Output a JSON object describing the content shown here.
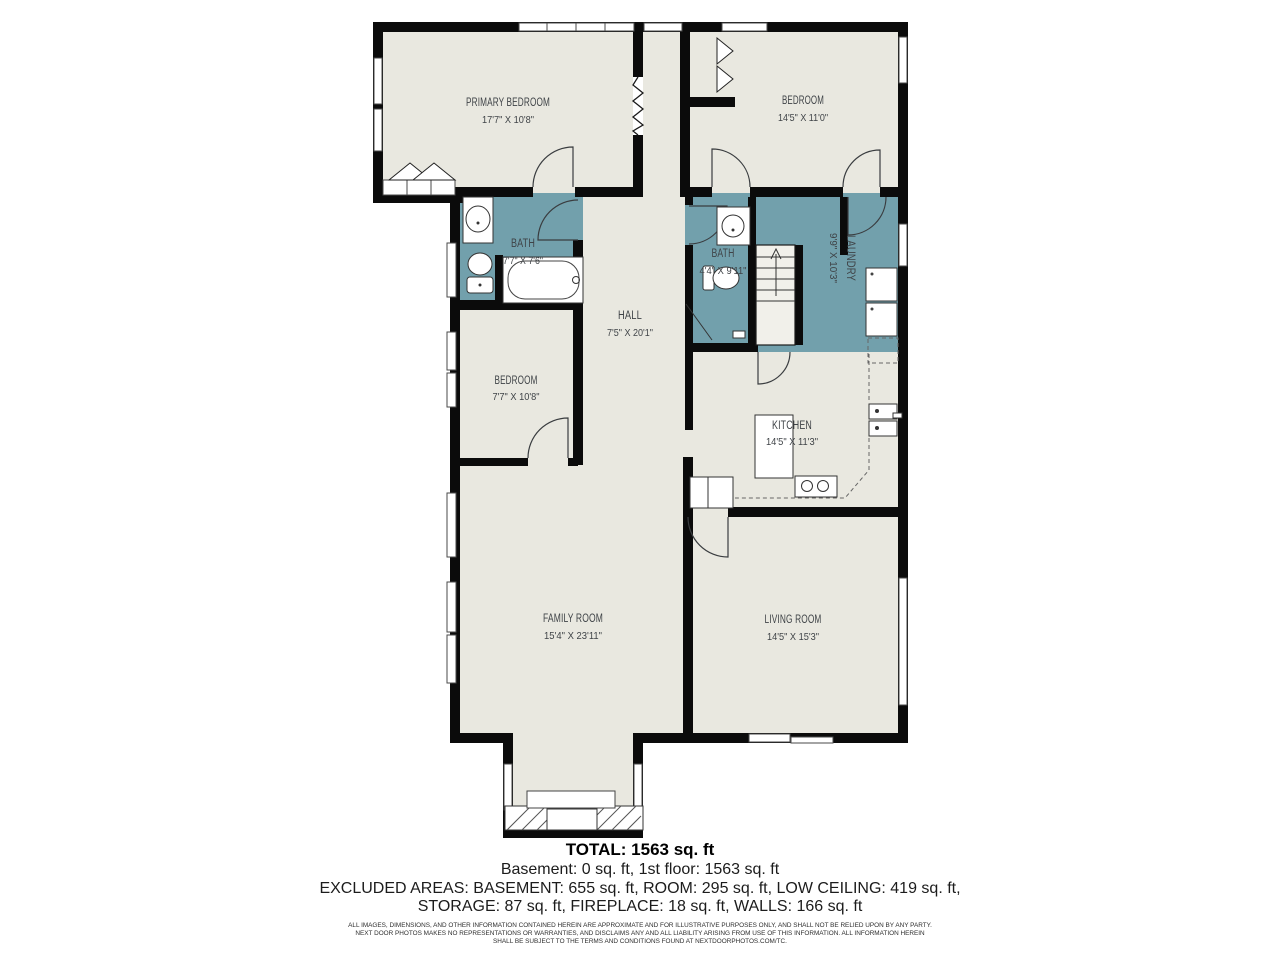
{
  "plan": {
    "rooms": [
      {
        "name": "PRIMARY BEDROOM",
        "dims": "17'7\" X 10'8\""
      },
      {
        "name": "BEDROOM",
        "dims": "14'5\" X 11'0\""
      },
      {
        "name": "BATH",
        "dims": "7'7\" X 7'6\""
      },
      {
        "name": "BATH",
        "dims": "4'4\" X 9'11\""
      },
      {
        "name": "LAUNDRY",
        "dims": "9'9\" X 10'3\""
      },
      {
        "name": "HALL",
        "dims": "7'5\" X 20'1\""
      },
      {
        "name": "BEDROOM",
        "dims": "7'7\" X 10'8\""
      },
      {
        "name": "KITCHEN",
        "dims": "14'5\" X 11'3\""
      },
      {
        "name": "FAMILY ROOM",
        "dims": "15'4\" X 23'11\""
      },
      {
        "name": "LIVING ROOM",
        "dims": "14'5\" X 15'3\""
      }
    ],
    "colors": {
      "wet_area": "#72a0ac",
      "floor": "#e9e8e0",
      "wall": "#0b0b0b"
    }
  },
  "summary": {
    "total": "TOTAL: 1563 sq. ft",
    "floors": "Basement: 0 sq. ft, 1st floor: 1563 sq. ft",
    "excluded_1": "EXCLUDED AREAS: BASEMENT: 655 sq. ft, ROOM: 295 sq. ft, LOW CEILING: 419 sq. ft,",
    "excluded_2": "STORAGE: 87 sq. ft, FIREPLACE: 18 sq. ft, WALLS: 166 sq. ft"
  },
  "disclaimer": {
    "line1": "ALL IMAGES, DIMENSIONS, AND OTHER INFORMATION CONTAINED HEREIN ARE APPROXIMATE AND FOR ILLUSTRATIVE PURPOSES ONLY, AND SHALL NOT BE RELIED UPON BY ANY PARTY.",
    "line2": "NEXT DOOR PHOTOS MAKES NO REPRESENTATIONS OR WARRANTIES, AND DISCLAIMS ANY AND ALL LIABILITY ARISING FROM USE OF THIS INFORMATION. ALL INFORMATION HEREIN",
    "line3": "SHALL BE SUBJECT TO THE TERMS AND CONDITIONS FOUND AT NEXTDOORPHOTOS.COM/TC."
  }
}
